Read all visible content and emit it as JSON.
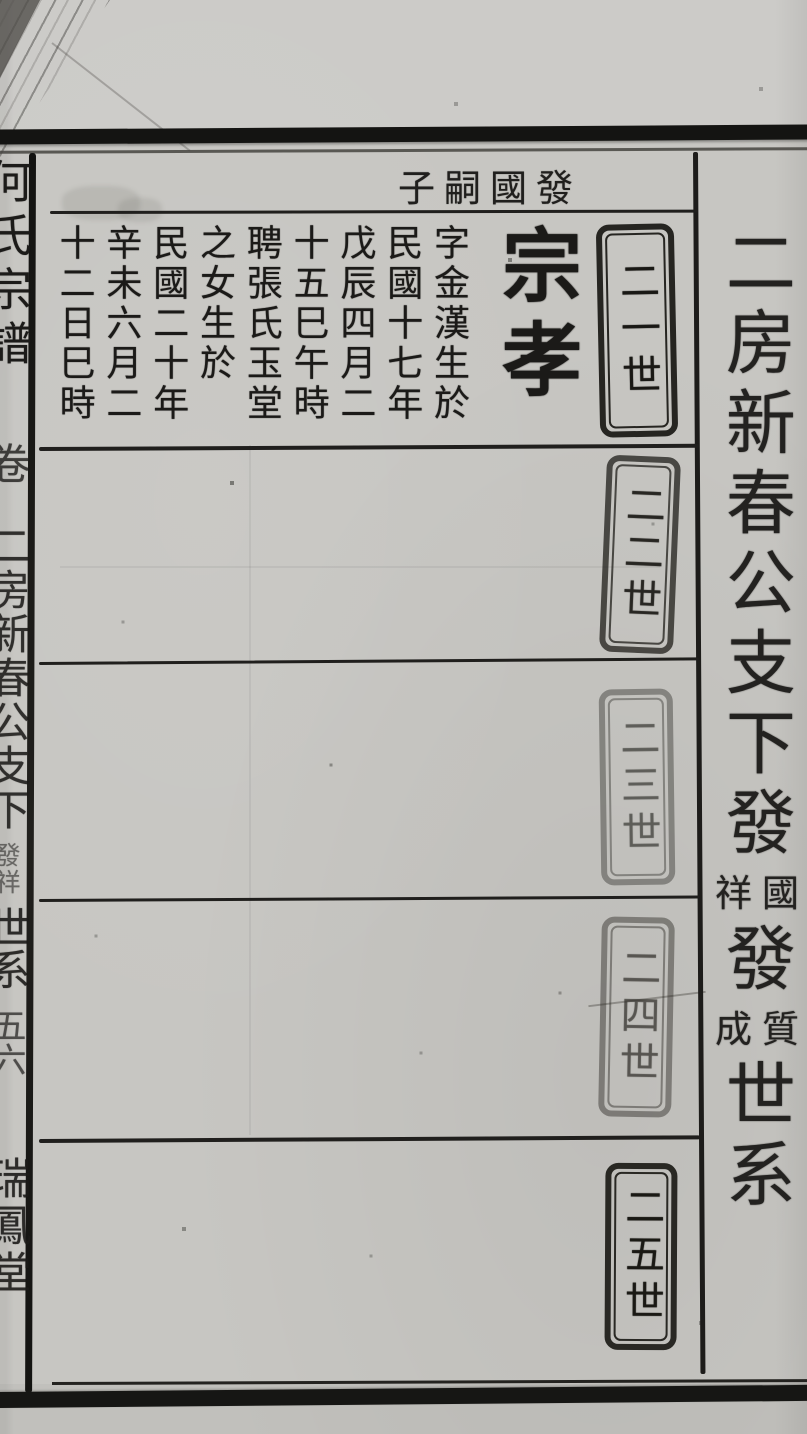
{
  "spine": {
    "book_title": "何氏宗譜",
    "volume_label": "卷",
    "section_title": "二房新春公支下",
    "section_small": "發祥",
    "section_suffix": "世系",
    "page_number": "五六",
    "hall_name": "瑞鳳堂"
  },
  "header": {
    "display_text": "子嗣國發",
    "reading": "發國嗣子"
  },
  "title_column": {
    "large_1": "二房新春公支下發",
    "pair_1": {
      "right": "國",
      "left": "祥"
    },
    "large_2": "發",
    "pair_2": {
      "right": "質",
      "left": "成"
    },
    "large_3": "世系"
  },
  "generations": [
    {
      "label": "二一世"
    },
    {
      "label": "二二世"
    },
    {
      "label": "二三世"
    },
    {
      "label": "二四世"
    },
    {
      "label": "二五世"
    }
  ],
  "entry": {
    "name": "宗孝",
    "columns": [
      "字金漢生於",
      "民國十七年",
      "戊辰四月二",
      "十五巳午時",
      "聘張氏玉堂",
      "之女生於",
      "民國二十年",
      "辛未六月二",
      "十二日巳時"
    ]
  }
}
